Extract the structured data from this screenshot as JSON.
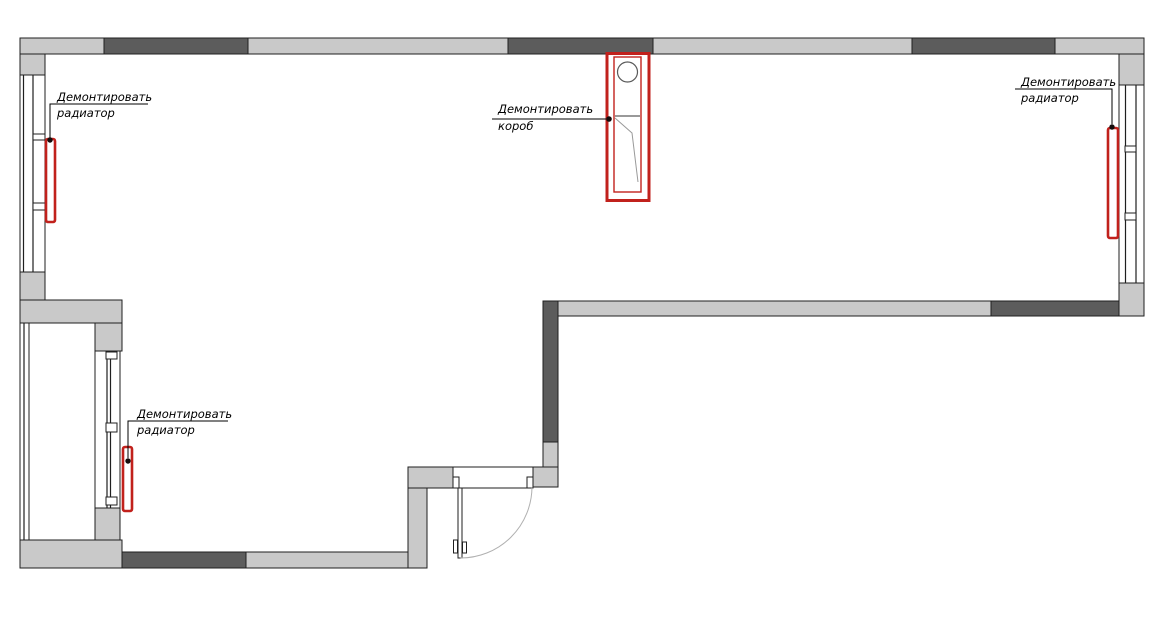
{
  "colors": {
    "background": "#ffffff",
    "wall_light": "#c9c9c9",
    "wall_dark": "#5c5c5c",
    "outline": "#1f1f1f",
    "demolition_red": "#c1211c",
    "door_arc": "#b0b0b0",
    "duct_detail": "#999999"
  },
  "plan": {
    "type": "demolition-floor-plan",
    "annotations": {
      "radiator_top_left": {
        "line1": "Демонтировать",
        "line2": "радиатор"
      },
      "duct_center": {
        "line1": "Демонтировать",
        "line2": "короб"
      },
      "radiator_top_right": {
        "line1": "Демонтировать",
        "line2": "радиатор"
      },
      "radiator_bottom_left": {
        "line1": "Демонтировать",
        "line2": "радиатор"
      }
    }
  }
}
